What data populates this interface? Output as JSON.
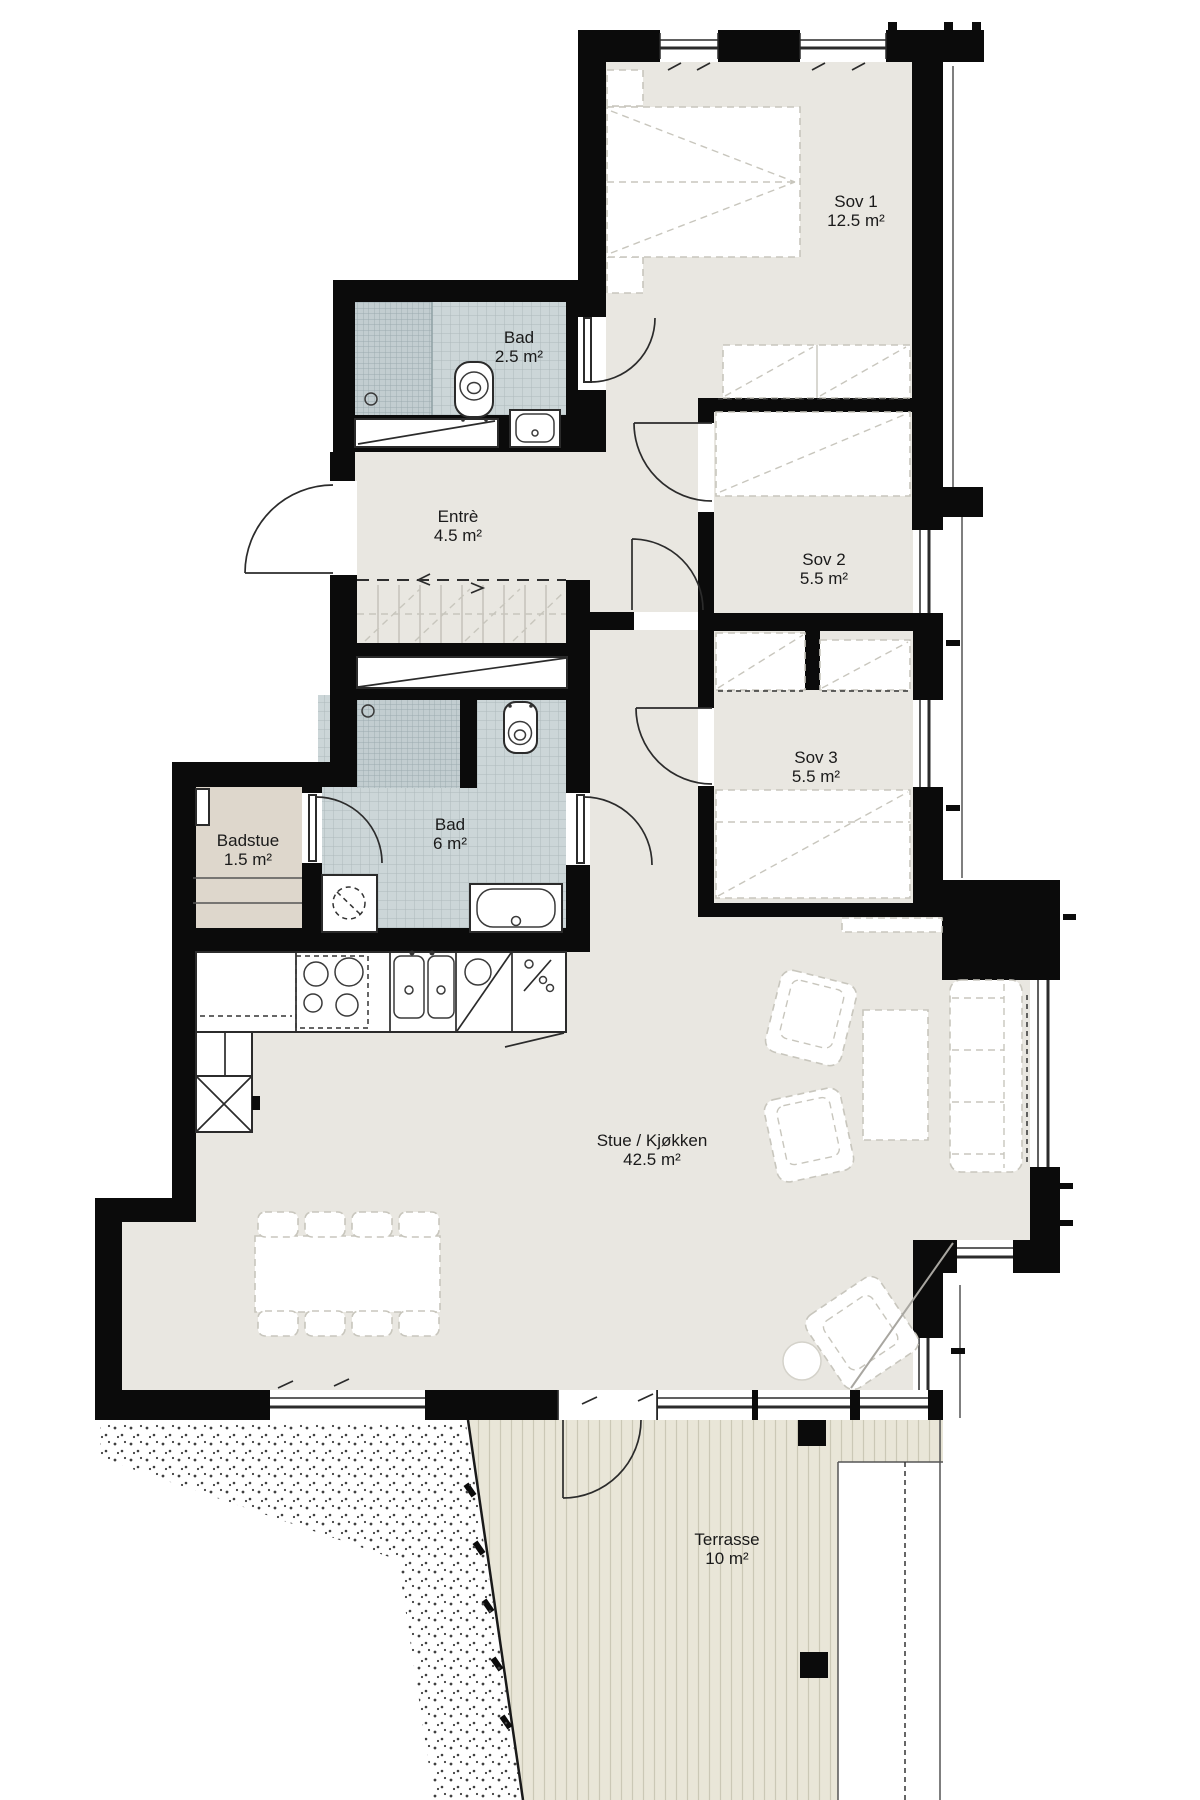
{
  "plan": {
    "type": "apartment-floor-plan",
    "colors": {
      "wall": "#0b0b0b",
      "floor": "#e9e7e1",
      "tile_light": "#ccd6d8",
      "tile_dark": "#c2cdd0",
      "badstue_floor": "#ded7cc",
      "terrace_floor": "#e9e6d8",
      "background": "#ffffff"
    },
    "rooms": [
      {
        "id": "sov1",
        "name": "Sov 1",
        "area": "12.5 m²"
      },
      {
        "id": "bad-upper",
        "name": "Bad",
        "area": "2.5 m²"
      },
      {
        "id": "entre",
        "name": "Entrè",
        "area": "4.5 m²"
      },
      {
        "id": "sov2",
        "name": "Sov 2",
        "area": "5.5 m²"
      },
      {
        "id": "sov3",
        "name": "Sov 3",
        "area": "5.5 m²"
      },
      {
        "id": "badstue",
        "name": "Badstue",
        "area": "1.5 m²"
      },
      {
        "id": "bad-main",
        "name": "Bad",
        "area": "6 m²"
      },
      {
        "id": "stue",
        "name": "Stue / Kjøkken",
        "area": "42.5 m²"
      },
      {
        "id": "terrasse",
        "name": "Terrasse",
        "area": "10 m²"
      }
    ]
  }
}
